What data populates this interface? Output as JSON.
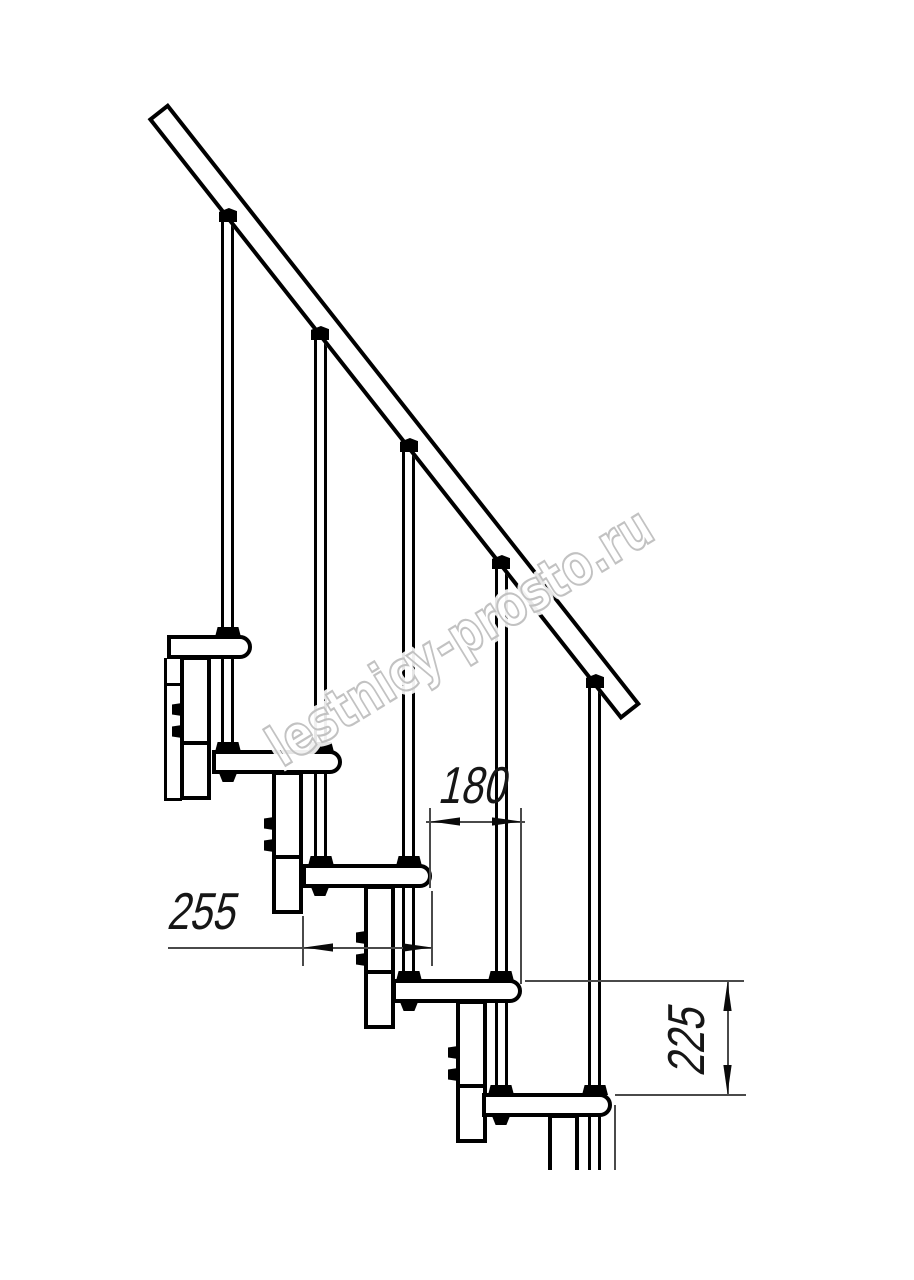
{
  "diagram": {
    "type": "technical-drawing",
    "subject": "Side elevation fragment of a modular staircase: inclined handrail, baluster rods, five treads with rounded noses and stacked support modules with bolted joints",
    "counts": {
      "treads": 5,
      "baluster_rods": 5,
      "support_modules": 5
    }
  },
  "dimensions": {
    "run": "180",
    "depth": "255",
    "rise": "225"
  },
  "watermark": {
    "text": "lestnicy-prosto.ru"
  },
  "colors": {
    "line": "#000000",
    "dimension_line": "#4a4a4a",
    "watermark_outline": "#c2c2c2",
    "background": "#ffffff"
  }
}
